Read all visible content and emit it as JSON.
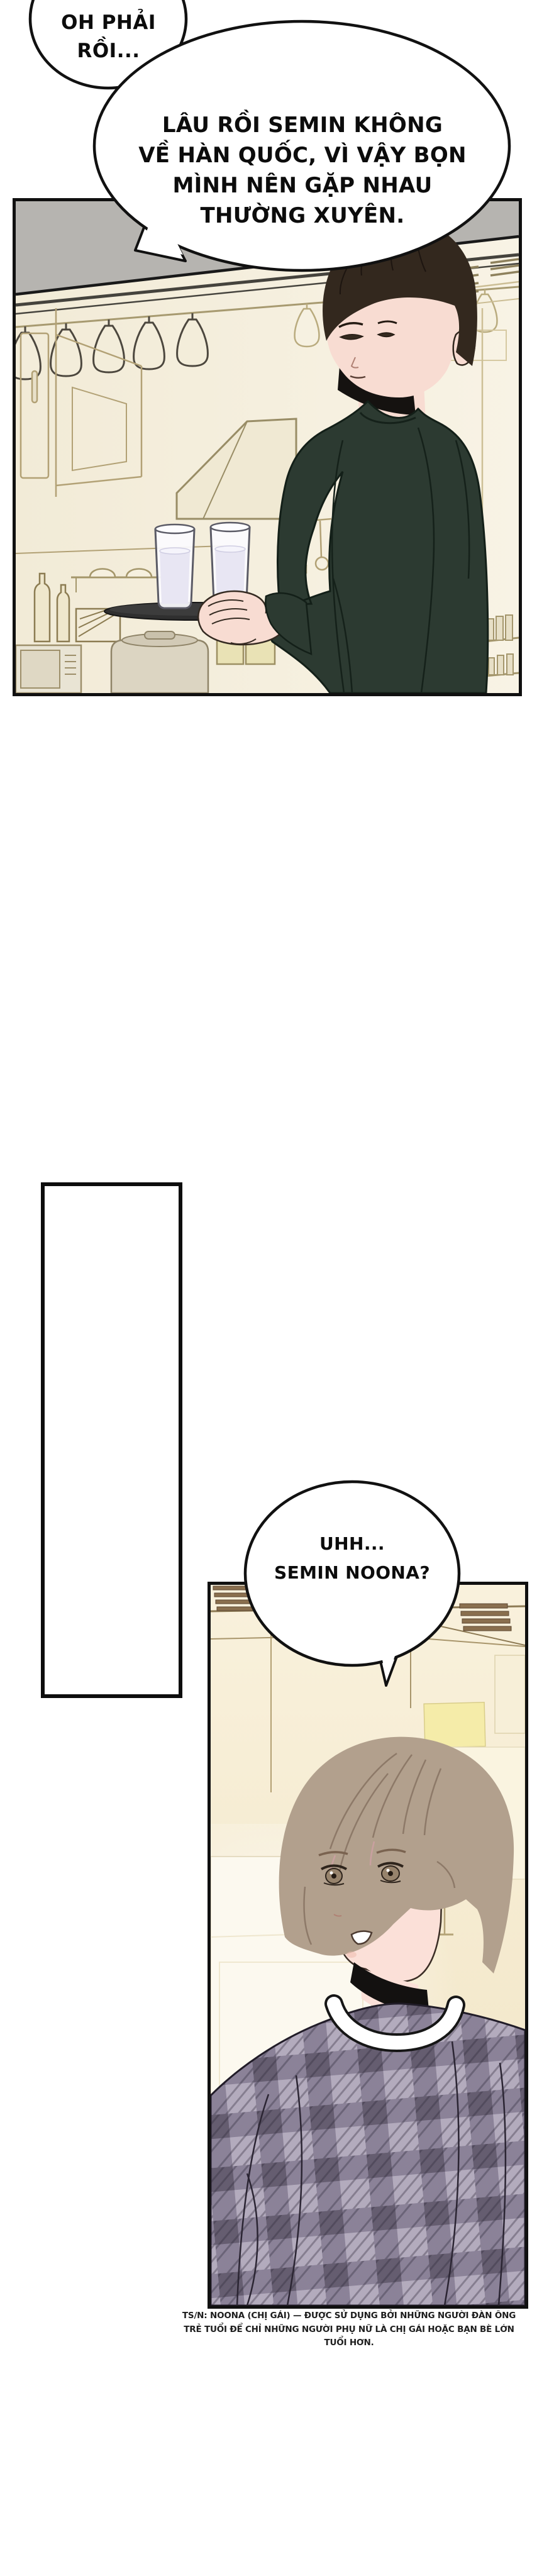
{
  "bubbles": {
    "b1": {
      "lines": [
        "OH PHẢI",
        "RỒI..."
      ]
    },
    "b2": {
      "lines": [
        "LÂU RỒI SEMIN KHÔNG",
        "VỀ HÀN QUỐC, VÌ VẬY BỌN",
        "MÌNH NÊN GẶP NHAU",
        "THƯỜNG XUYÊN."
      ]
    },
    "b3": {
      "lines": [
        "UHH...",
        "SEMIN NOONA?"
      ]
    }
  },
  "footer": {
    "lines": [
      "TS/N: NOONA (CHỊ GÁI) — ĐƯỢC SỬ DỤNG BỞI NHỮNG NGƯỜI ĐÀN ÔNG",
      "TRẺ TUỔI ĐỂ CHỈ NHỮNG NGƯỜI PHỤ NỮ LÀ CHỊ GÁI HOẶC BẠN BÈ LỚN",
      "TUỔI HƠN."
    ]
  },
  "colors": {
    "panel_border": "#101010",
    "kitchen_bg": "#f3ecd9",
    "ceiling_gray": "#b6b4b0",
    "sweater_green": "#2c3a31",
    "skin": "#f8dcd2",
    "hair_dark": "#33281e",
    "hair_light": "#b2a08d",
    "plaid_base": "#b3abbd",
    "plaid_dark": "#655d70",
    "note_yellow": "#f5eca9",
    "line_tan": "#b2a175"
  }
}
